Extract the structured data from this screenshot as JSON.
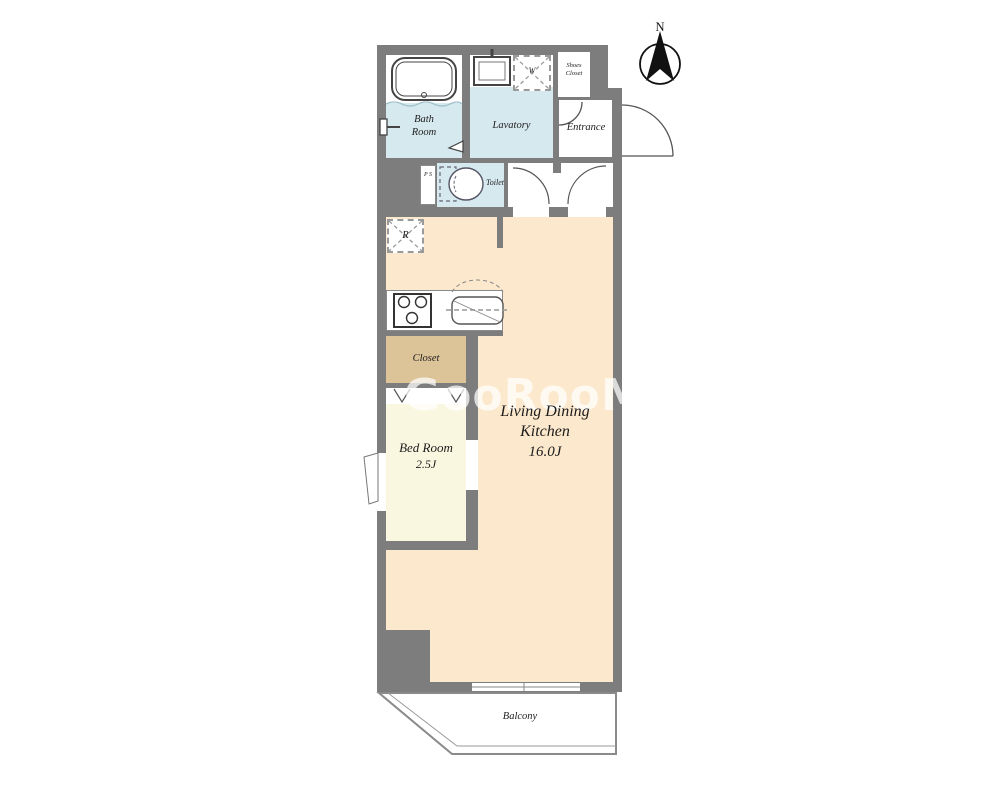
{
  "plan": {
    "compass_label": "N",
    "watermark": "GooRooM",
    "rooms": {
      "bath": {
        "label": "Bath Room"
      },
      "lavatory": {
        "label": "Lavatory"
      },
      "shoes_closet": {
        "label": "Shoes Closet"
      },
      "entrance": {
        "label": "Entrance"
      },
      "pipe_space": {
        "label": "P S"
      },
      "toilet": {
        "label": "Toilet"
      },
      "ldk": {
        "label": "Living Dining Kitchen",
        "size": "16.0J"
      },
      "bedroom": {
        "label": "Bed Room",
        "size": "2.5J"
      },
      "closet": {
        "label": "Closet"
      },
      "balcony": {
        "label": "Balcony"
      }
    },
    "fixtures": {
      "refrigerator_label": "R",
      "washer_label": "W"
    },
    "colors": {
      "wall": "#7d7d7d",
      "ldk_floor": "#fce8cc",
      "wet_area_floor": "#d6e9ef",
      "bedroom_floor": "#faf7e0",
      "closet_floor": "#dcc398",
      "fixture_outline": "#555555"
    }
  }
}
